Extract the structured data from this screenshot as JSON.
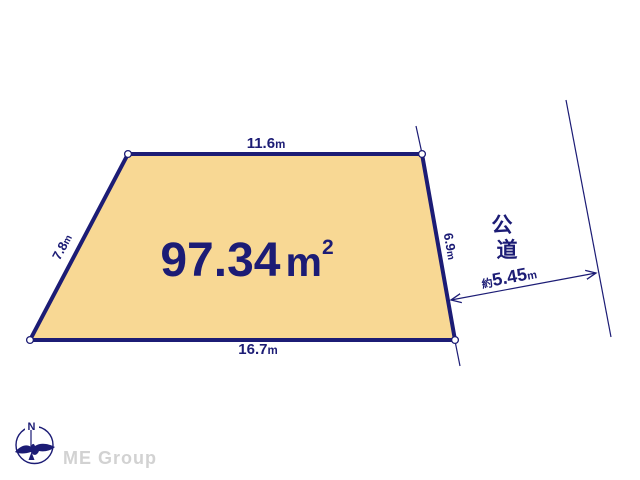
{
  "diagram": {
    "area_label": {
      "value": "97.34",
      "unit": "m",
      "superscript": "2"
    },
    "dimensions": {
      "top": {
        "value": "11.6",
        "unit": "m"
      },
      "left": {
        "value": "7.8",
        "unit": "m"
      },
      "right": {
        "value": "6.9",
        "unit": "m"
      },
      "bottom": {
        "value": "16.7",
        "unit": "m"
      },
      "road_width": {
        "prefix": "約",
        "value": "5.45",
        "unit": "m"
      }
    },
    "road_label": [
      "公",
      "道"
    ],
    "compass": {
      "north": "N"
    },
    "brand": "ME Group",
    "colors": {
      "plot_fill": "#f8d894",
      "line": "#1c1c75",
      "watermark": "#d2d2d2"
    }
  }
}
